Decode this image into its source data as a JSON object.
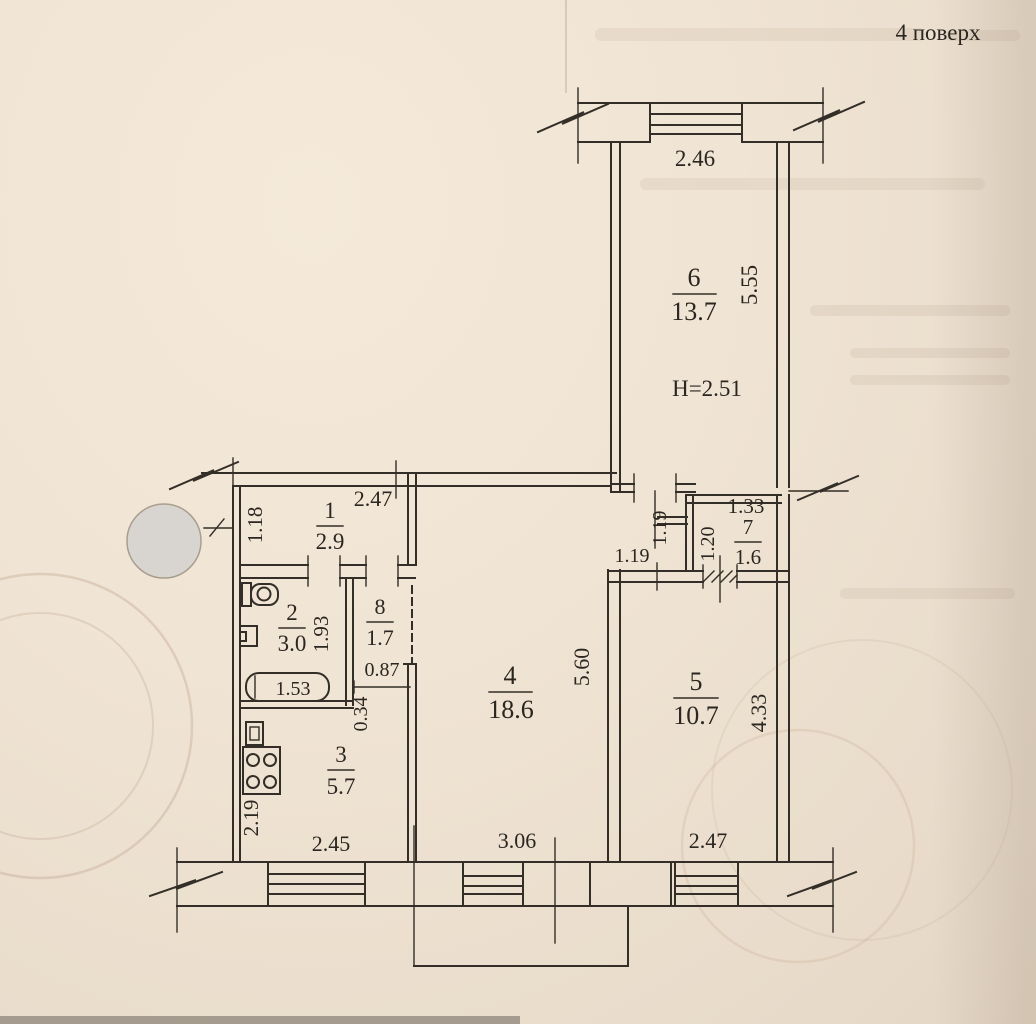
{
  "page": {
    "floor_label": "4 поверх"
  },
  "rooms": {
    "r1": {
      "num": "1",
      "area": "2.9"
    },
    "r2": {
      "num": "2",
      "area": "3.0"
    },
    "r3": {
      "num": "3",
      "area": "5.7"
    },
    "r4": {
      "num": "4",
      "area": "18.6"
    },
    "r5": {
      "num": "5",
      "area": "10.7"
    },
    "r6": {
      "num": "6",
      "area": "13.7"
    },
    "r7": {
      "num": "7",
      "area": "1.6"
    },
    "r8": {
      "num": "8",
      "area": "1.7"
    }
  },
  "dims": {
    "top_window": "2.46",
    "r6_depth": "5.55",
    "ceiling_height": "H=2.51",
    "hall_width": "2.47",
    "hall_side": "1.18",
    "bath_depth": "1.93",
    "bathtub": "1.53",
    "wc_width": "0.87",
    "wc_side": "0.34",
    "kitchen_side": "2.19",
    "kitchen_width": "2.45",
    "living_width": "3.06",
    "living_depth": "5.60",
    "bedroom_width": "2.47",
    "bedroom_depth": "4.33",
    "nook_depth": "1.19",
    "nook_width": "1.19",
    "closet_width": "1.33",
    "closet_depth": "1.20"
  }
}
